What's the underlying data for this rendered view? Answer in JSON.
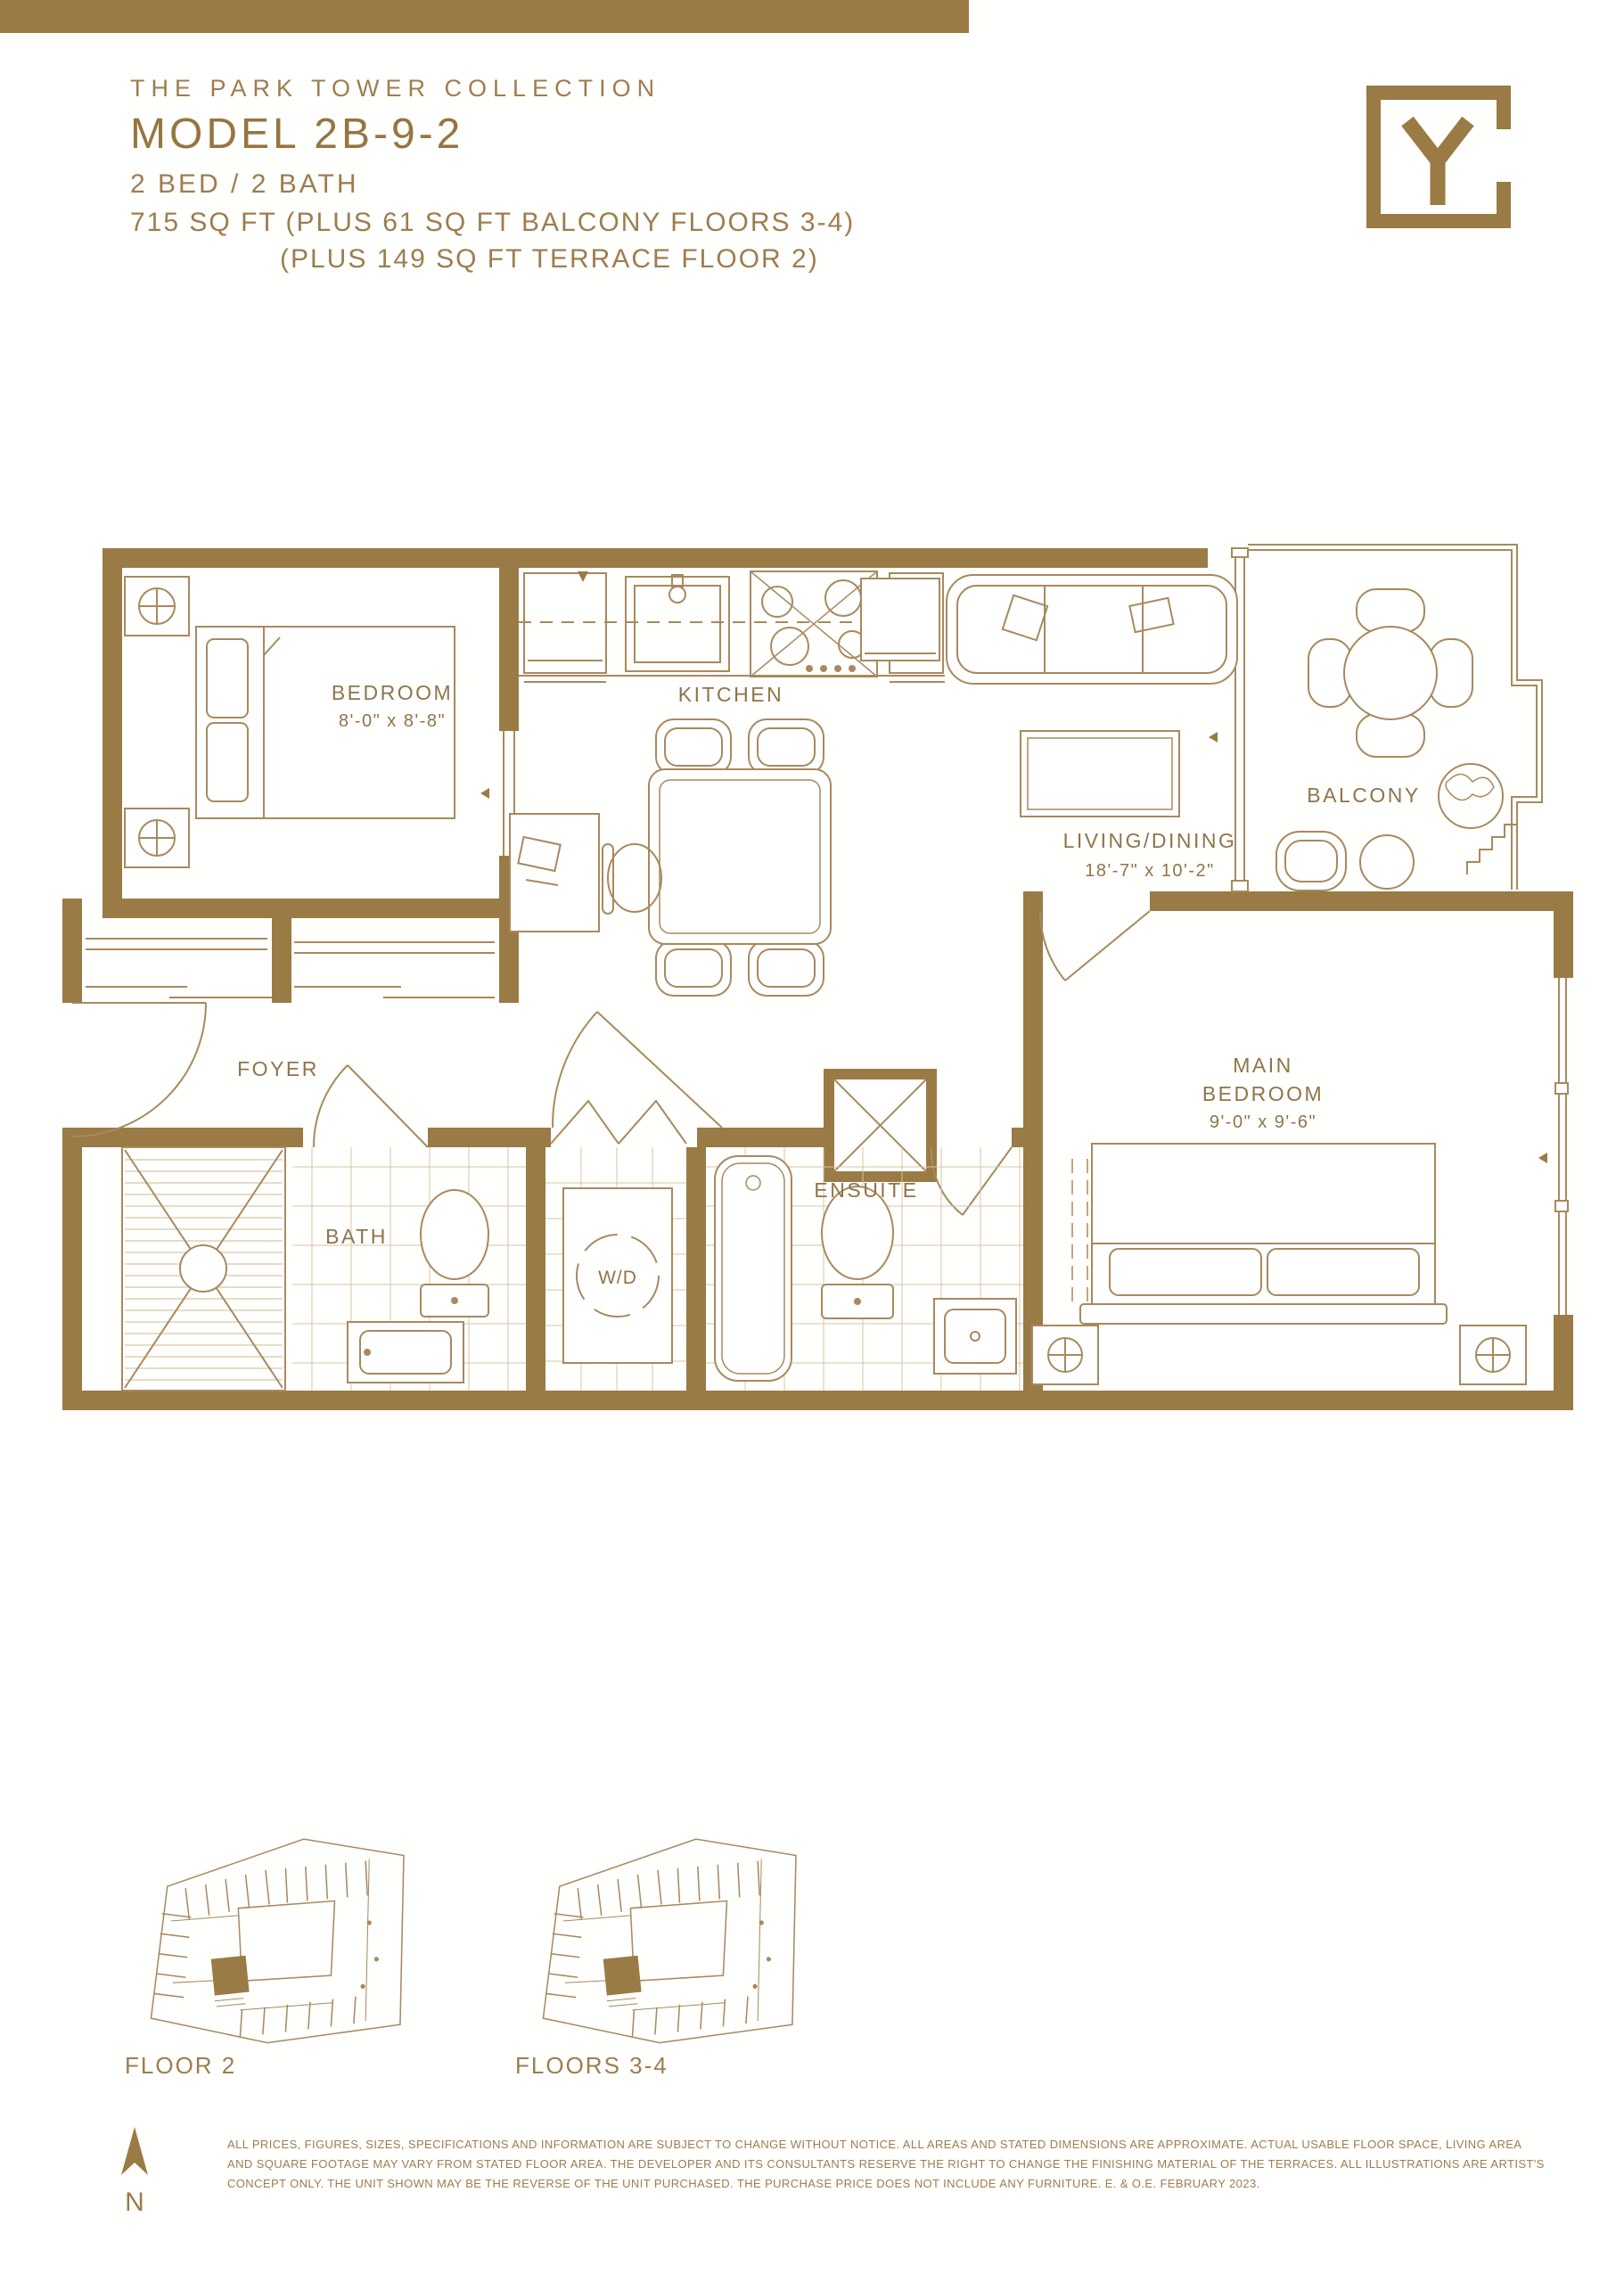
{
  "colors": {
    "accent": "#9a7a45",
    "plan_line": "#a8895e",
    "tile_line": "#d8c5a2",
    "label_text": "#8f744a",
    "header_text": "#9d7d4f"
  },
  "header": {
    "collection": "THE PARK TOWER COLLECTION",
    "model": "MODEL 2B-9-2",
    "config": "2 BED / 2 BATH",
    "area_line1": "715 SQ FT (PLUS 61 SQ FT BALCONY FLOORS 3-4)",
    "area_line2": "(PLUS 149 SQ FT TERRACE FLOOR 2)",
    "logo_letter": "Y"
  },
  "plan": {
    "rooms": {
      "bedroom": {
        "label": "BEDROOM",
        "dims": "8'-0\" x 8'-8\""
      },
      "kitchen": {
        "label": "KITCHEN"
      },
      "living_dining": {
        "label": "LIVING/DINING",
        "dims": "18'-7\" x 10'-2\""
      },
      "balcony": {
        "label": "BALCONY"
      },
      "foyer": {
        "label": "FOYER"
      },
      "bath": {
        "label": "BATH"
      },
      "washer_dryer": {
        "label": "W/D"
      },
      "ensuite": {
        "label": "ENSUITE"
      },
      "main_bedroom": {
        "label_line1": "MAIN",
        "label_line2": "BEDROOM",
        "dims": "9'-0\" x 9'-6\""
      }
    }
  },
  "key_plans": {
    "floor2": "FLOOR 2",
    "floors34": "FLOORS 3-4"
  },
  "compass": {
    "label": "N"
  },
  "disclaimer": {
    "line1": "ALL PRICES, FIGURES, SIZES, SPECIFICATIONS AND INFORMATION ARE SUBJECT TO CHANGE WITHOUT NOTICE. ALL AREAS AND STATED DIMENSIONS ARE APPROXIMATE. ACTUAL USABLE FLOOR SPACE, LIVING AREA",
    "line2": "AND SQUARE FOOTAGE MAY VARY FROM STATED FLOOR AREA. THE DEVELOPER AND ITS CONSULTANTS RESERVE THE RIGHT TO CHANGE THE FINISHING MATERIAL OF THE TERRACES. ALL ILLUSTRATIONS ARE ARTIST'S",
    "line3": "CONCEPT ONLY. THE UNIT SHOWN MAY BE THE REVERSE OF THE UNIT PURCHASED. THE PURCHASE PRICE DOES NOT INCLUDE ANY FURNITURE. E. & O.E. FEBRUARY 2023."
  }
}
